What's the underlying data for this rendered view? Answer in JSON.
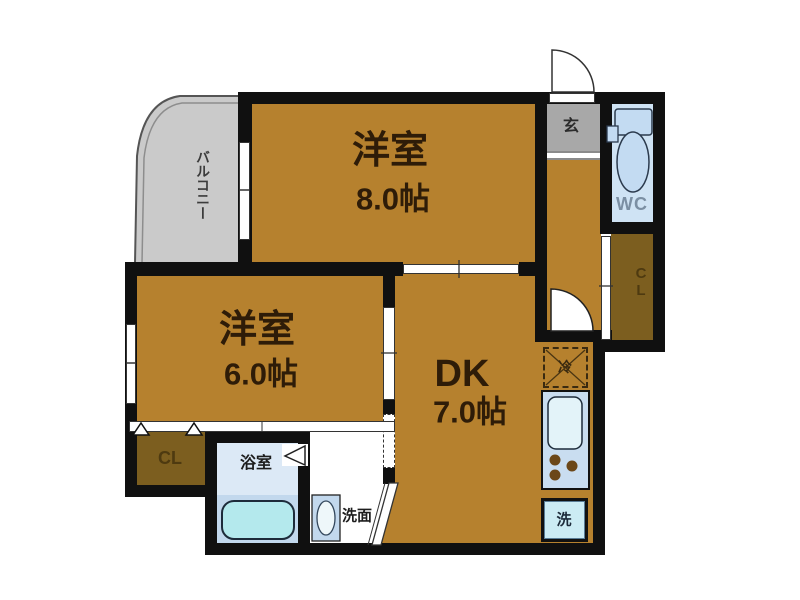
{
  "title": "2DK apartment floor plan",
  "labels": {
    "room8": {
      "name": "洋室",
      "size": "8.0帖"
    },
    "room6": {
      "name": "洋室",
      "size": "6.0帖"
    },
    "dk": {
      "name": "DK",
      "size": "7.0帖"
    },
    "balcony": "バルコニー",
    "entrance": "玄",
    "wc": "WC",
    "closet_right": "CL",
    "closet_left": "CL",
    "bathroom": "浴室",
    "washroom": "洗面",
    "refrigerator": "冷",
    "laundry": "洗"
  },
  "colors": {
    "wall": "#101010",
    "room_fill": "#b6812e",
    "closet_fill": "#7c5e1f",
    "balcony_fill": "#cacaca",
    "entrance_floor": "#a8a8a8",
    "wet_area_blue": "#cfe3f4",
    "bathtub_fill": "#b4e9ed",
    "label_text": "#2e1c08",
    "wc_text": "#7b8fa3"
  }
}
